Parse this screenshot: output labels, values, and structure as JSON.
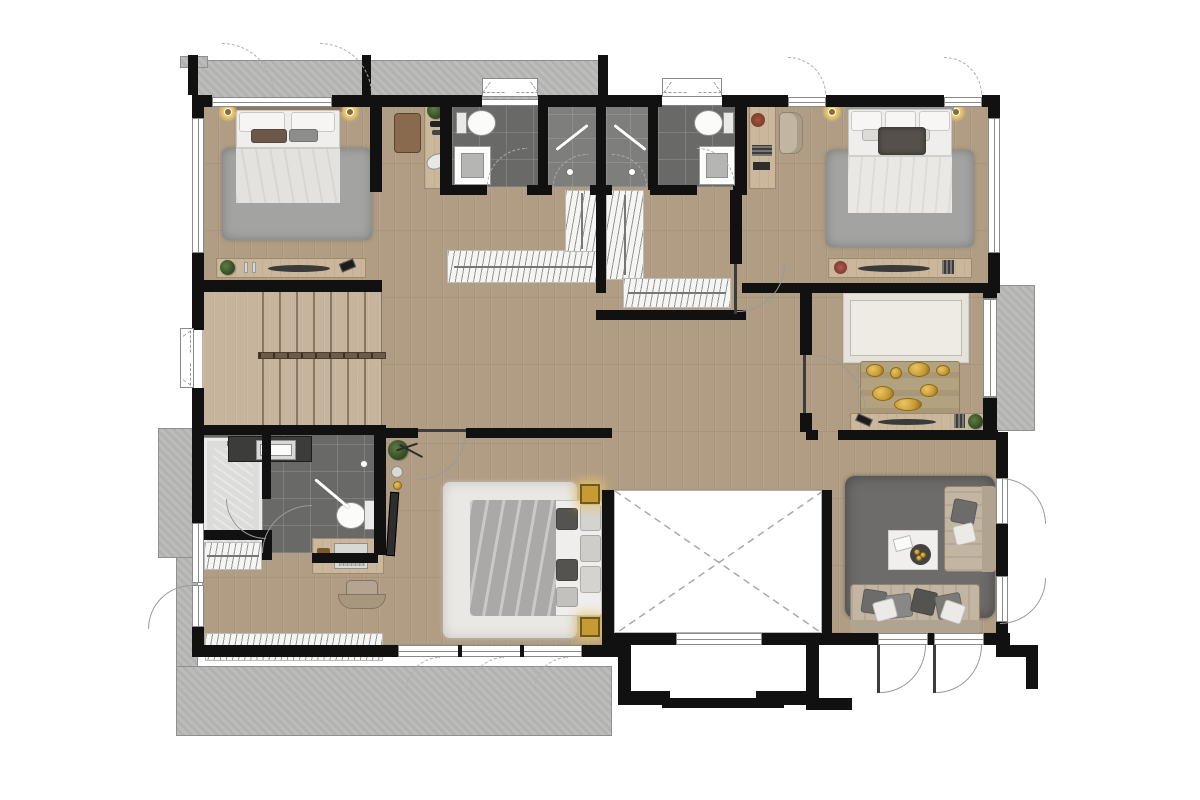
{
  "title": "upper-floor-plan",
  "colors": {
    "bg": "#ffffff",
    "wall": "#111111",
    "wood": "#b19d84",
    "wood_light": "#c6b59c",
    "tile": "#696967",
    "tile_light": "#7e7e7c",
    "concrete": "#b8b8b6",
    "concrete_edge": "#8f8f8d",
    "window": "#ffffff",
    "window_frame": "#8a8a8a",
    "rug_gray": "#a3a3a1",
    "rug_white": "#eae8e4",
    "rug_dark": "#6e6c6a",
    "rug_cream": "#edebe4",
    "bed_white": "#efeeec",
    "bed_gray": "#b9b7b5",
    "sofa_beige": "#c2b5a2",
    "sofa_dark": "#b0a38f",
    "pillow_dark": "#55534f",
    "gold": "#c79a33",
    "water": "#9fc3cf",
    "plant": "#3f5c31",
    "wood_furniture": "#cbb89c",
    "arc": "#9a9a98"
  },
  "rooms": [
    {
      "name": "bedroom-1"
    },
    {
      "name": "vanity-nook"
    },
    {
      "name": "bathroom-1"
    },
    {
      "name": "shower-room-1"
    },
    {
      "name": "shower-room-2"
    },
    {
      "name": "bathroom-2"
    },
    {
      "name": "reading-nook"
    },
    {
      "name": "bedroom-2"
    },
    {
      "name": "walk-in-closet"
    },
    {
      "name": "stair-hall"
    },
    {
      "name": "hallway"
    },
    {
      "name": "prayer-room"
    },
    {
      "name": "master-bathroom"
    },
    {
      "name": "dressing-area"
    },
    {
      "name": "master-bedroom"
    },
    {
      "name": "void-double-height"
    },
    {
      "name": "family-room"
    },
    {
      "name": "balcony-top"
    },
    {
      "name": "balcony-right"
    },
    {
      "name": "terrace-bottom"
    }
  ],
  "furniture": [
    "bed",
    "rug",
    "wall-lamp",
    "dresser",
    "plant",
    "perfume-set",
    "vanity-stool",
    "toilet",
    "shower-tray",
    "towel-rail",
    "wardrobe",
    "armchair",
    "book-stack",
    "flower-vase",
    "console-table",
    "prayer-rug",
    "gold-offering-set",
    "bathtub",
    "sink-counter",
    "mirror",
    "desk",
    "laptop",
    "office-chair",
    "spotlight",
    "coffee-table",
    "sofa",
    "throw-pillow",
    "stairs",
    "handrail",
    "sliding-door"
  ]
}
